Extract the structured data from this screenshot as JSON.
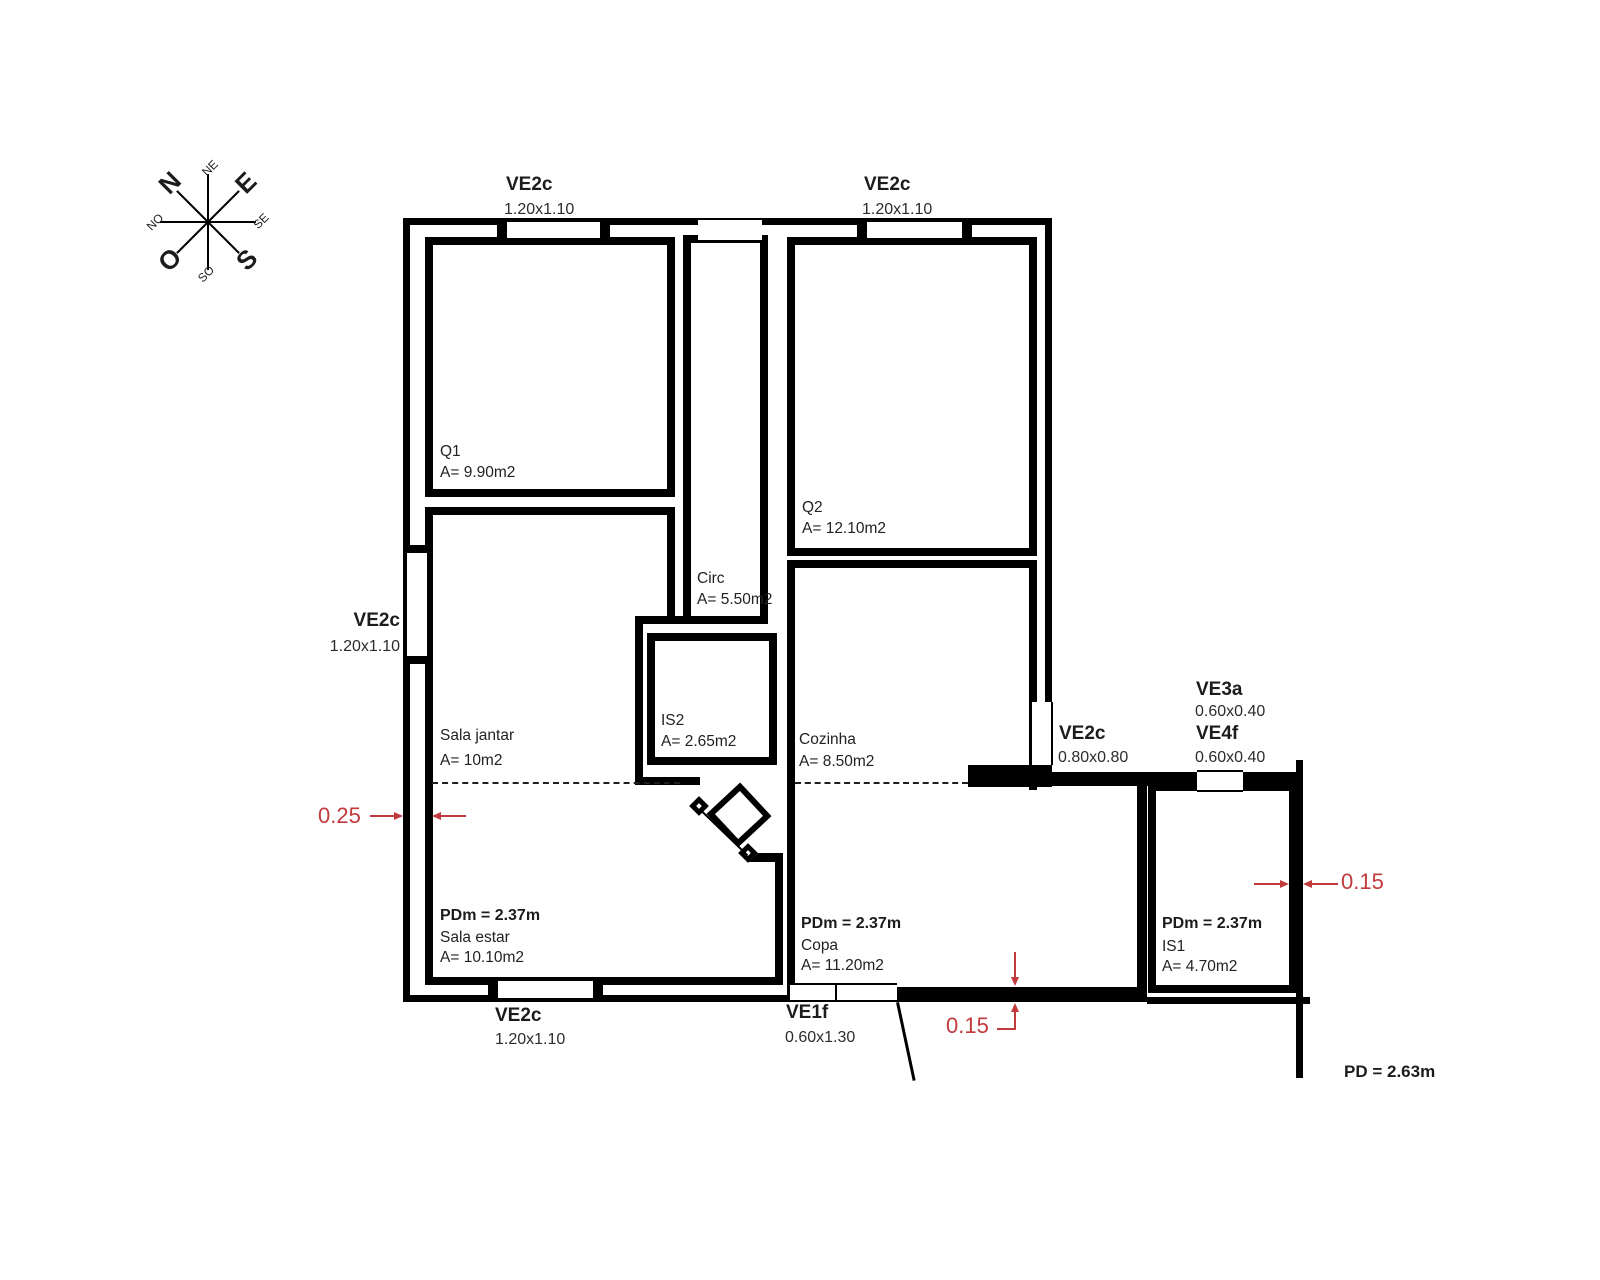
{
  "compass": {
    "n": "N",
    "e": "E",
    "o": "O",
    "s": "S",
    "ne": "NE",
    "se": "SE",
    "so": "SO",
    "no": "NO"
  },
  "windows": {
    "top_left": {
      "name": "VE2c",
      "size": "1.20x1.10"
    },
    "top_right": {
      "name": "VE2c",
      "size": "1.20x1.10"
    },
    "left": {
      "name": "VE2c",
      "size": "1.20x1.10"
    },
    "bottom": {
      "name": "VE2c",
      "size": "1.20x1.10"
    },
    "door": {
      "name": "VE1f",
      "size": "0.60x1.30"
    },
    "right_mid": {
      "name": "VE2c",
      "size": "0.80x0.80"
    },
    "ve3a": {
      "name": "VE3a",
      "size": "0.60x0.40"
    },
    "ve4f": {
      "name": "VE4f",
      "size": "0.60x0.40"
    }
  },
  "rooms": {
    "q1": {
      "name": "Q1",
      "area": "A= 9.90m2"
    },
    "q2": {
      "name": "Q2",
      "area": "A= 12.10m2"
    },
    "circ": {
      "name": "Circ",
      "area": "A= 5.50m2"
    },
    "is2": {
      "name": "IS2",
      "area": "A= 2.65m2"
    },
    "sala_jantar": {
      "name": "Sala jantar",
      "area": "A= 10m2"
    },
    "cozinha": {
      "name": "Cozinha",
      "area": "A= 8.50m2"
    },
    "sala_estar": {
      "pdm": "PDm = 2.37m",
      "name": "Sala estar",
      "area": "A= 10.10m2"
    },
    "copa": {
      "pdm": "PDm = 2.37m",
      "name": "Copa",
      "area": "A= 11.20m2"
    },
    "is1": {
      "pdm": "PDm = 2.37m",
      "name": "IS1",
      "area": "A= 4.70m2"
    }
  },
  "dimensions": {
    "wall_left": "0.25",
    "wall_bottom": "0.15",
    "wall_right": "0.15",
    "ceiling": "PD = 2.63m"
  },
  "colors": {
    "dimension_red": "#c03a3e",
    "line_black": "#000000"
  }
}
